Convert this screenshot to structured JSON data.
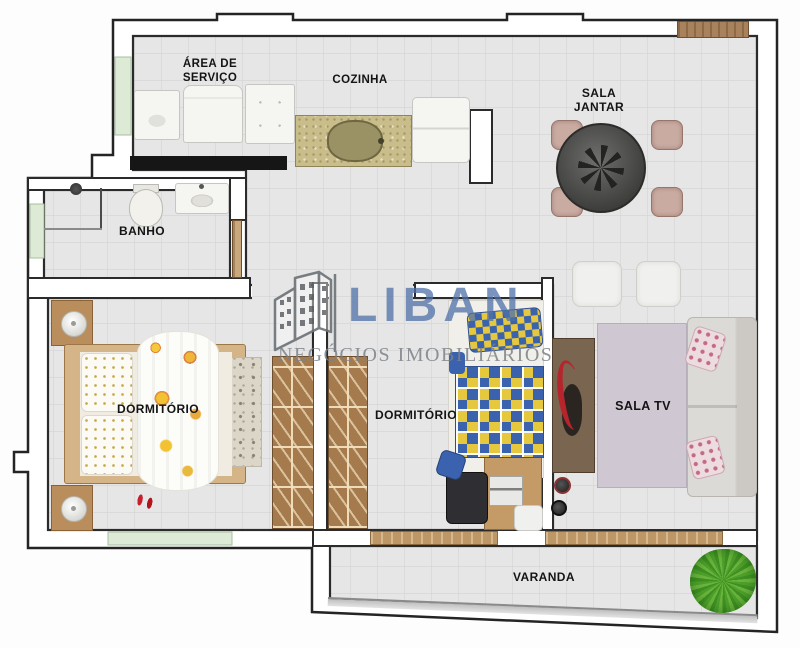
{
  "watermark": {
    "brand": "LIBAN",
    "tagline": "NEGÓCIOS IMOBILIÁRIOS",
    "brand_color": "#4e70a8",
    "tagline_color": "#7b8187"
  },
  "rooms": {
    "service_area": {
      "label": "ÁREA DE\nSERVIÇO"
    },
    "kitchen": {
      "label": "COZINHA"
    },
    "dining_room": {
      "label": "SALA\nJANTAR"
    },
    "bathroom": {
      "label": "BANHO"
    },
    "bedroom_left": {
      "label": "DORMITÓRIO"
    },
    "bedroom_middle": {
      "label": "DORMITÓRIO"
    },
    "tv_room": {
      "label": "SALA TV"
    },
    "balcony": {
      "label": "VARANDA"
    }
  },
  "palette": {
    "wall_outline": "#262626",
    "floor": "#e6e6e6",
    "floor_grid": "#d4d4d4",
    "window_green": "#dcead6",
    "wood_door": "#a8825d",
    "sliding_door": "#bd9766",
    "counter_black": "#161616",
    "granite": "#c9bd8b",
    "bed_blue": "#3b63ad",
    "bed_yellow": "#e6c83e",
    "plant_green": "#55a32e",
    "sofa_gray": "#dcdad6",
    "rug_lilac": "#cfc7d2",
    "wood_furniture": "#a57b4e"
  },
  "furniture": {
    "service_area": [
      "laundry-tank",
      "washing-machine",
      "cabinet"
    ],
    "kitchen": [
      "granite-counter",
      "kitchen-sink",
      "refrigerator"
    ],
    "bathroom": [
      "shower",
      "toilet",
      "washbasin",
      "door"
    ],
    "dining_room": [
      "round-dining-table",
      "dining-chairs",
      "ottomans"
    ],
    "bedroom_left": [
      "nightstands",
      "double-bed",
      "floral-blanket",
      "pillows",
      "rug",
      "wardrobe",
      "red-shoes"
    ],
    "bedroom_middle": [
      "wardrobe",
      "single-bed",
      "checkered-blanket",
      "desk",
      "office-chair",
      "laptop",
      "stool"
    ],
    "tv_room": [
      "tv-cabinet",
      "tv",
      "speakers",
      "rug",
      "sofa",
      "floral-cushions"
    ],
    "balcony": [
      "plant",
      "railing",
      "sliding-doors"
    ]
  }
}
